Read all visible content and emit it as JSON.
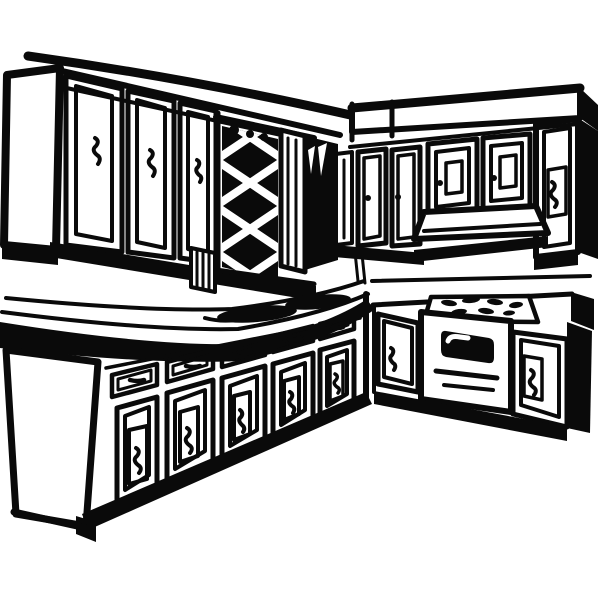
{
  "figure": {
    "title": "Retro kitchen clipart",
    "description": "Black-and-white retro clipart line drawing of an L-shaped kitchen corner: upper wall cabinets, a diamond-lattice window panel, a soffit, lower base cabinets with drawers and doors, a countertop with sink shadows, a cooktop with burners, a range hood and an oven.",
    "style": "black ink line art on white",
    "palette": {
      "ink": "#0a0a0a",
      "background": "#ffffff"
    }
  },
  "parts": {
    "ceiling": "ceiling line",
    "upper_cabinets_left": "upper wall cabinets, left wall",
    "lattice_window": "diamond lattice window panel",
    "soffit": "soffit above right wall cabinets",
    "upper_cabinets_right": "upper wall cabinets, right wall",
    "range_hood": "range hood",
    "countertop_left": "left countertop",
    "sink_area": "sink shadows on left countertop",
    "base_cabinets_left": "left base cabinets with drawers and doors",
    "countertop_right": "right countertop",
    "cooktop": "cooktop burners",
    "oven": "oven with window and handle",
    "base_cabinets_right": "right base cabinets"
  }
}
